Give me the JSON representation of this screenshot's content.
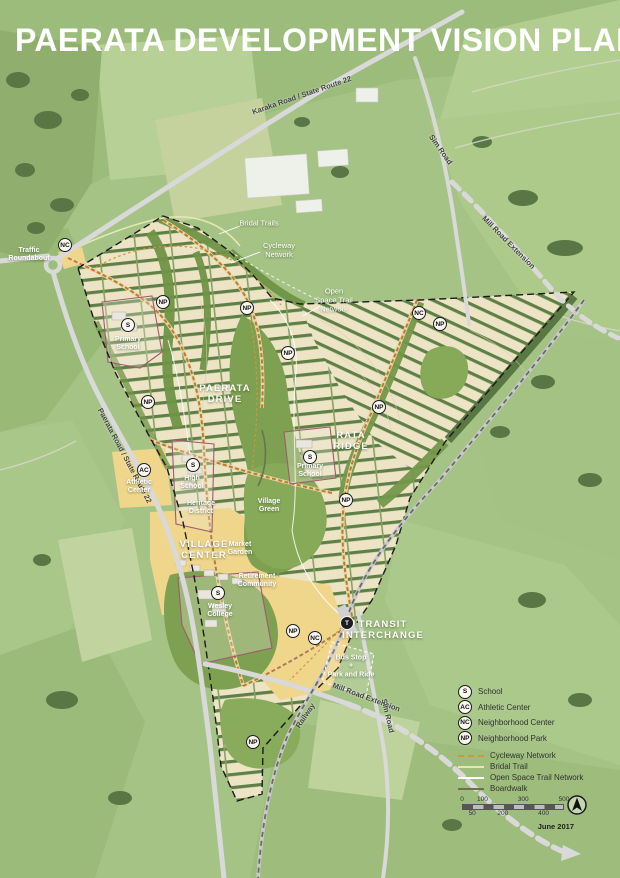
{
  "title": "PAERATA DEVELOPMENT VISION PLAN",
  "date": "June 2017",
  "colors": {
    "plan_cream": "#ece4c5",
    "street_green": "#5e8047",
    "village_green": "#7da150",
    "yellow_zone": "#f0d68b",
    "main_street_orange": "#bf7a30",
    "cycleway_orange": "#d0983c",
    "bridal_trail": "#e4e8b6",
    "open_space_trail": "#ffffff",
    "boardwalk": "#6f6f52",
    "road_gray": "#d9d9d9",
    "boundary_black": "#1b1b1b"
  },
  "road_labels": [
    {
      "text": "Karaka Road / State Route 22",
      "x": 302,
      "y": 96,
      "rotate": -19
    },
    {
      "text": "Sim Road",
      "x": 440,
      "y": 150,
      "rotate": 55
    },
    {
      "text": "Mill Road Extension",
      "x": 508,
      "y": 243,
      "rotate": 45
    },
    {
      "text": "Paerata Road / State Route 22",
      "x": 124,
      "y": 456,
      "rotate": 62
    },
    {
      "text": "Mill Road Extension",
      "x": 366,
      "y": 698,
      "rotate": 20
    },
    {
      "text": "Sim Road",
      "x": 387,
      "y": 716,
      "rotate": 77
    },
    {
      "text": "Railway",
      "x": 306,
      "y": 716,
      "rotate": -56
    }
  ],
  "area_labels": [
    {
      "text": "PAERATA\nDRIVE",
      "x": 225,
      "y": 394,
      "style": "district"
    },
    {
      "text": "RATA\nRIDGE",
      "x": 351,
      "y": 441,
      "style": "district"
    },
    {
      "text": "VILLAGE\nCENTER",
      "x": 204,
      "y": 550,
      "style": "district"
    },
    {
      "text": "TRANSIT\nINTERCHANGE",
      "x": 383,
      "y": 630,
      "style": "district"
    },
    {
      "text": "Primary\nSchool",
      "x": 128,
      "y": 344,
      "style": "feature"
    },
    {
      "text": "Primary\nSchool",
      "x": 310,
      "y": 471,
      "style": "feature"
    },
    {
      "text": "High\nSchool",
      "x": 192,
      "y": 483,
      "style": "feature"
    },
    {
      "text": "Athletic\nCenter",
      "x": 139,
      "y": 487,
      "style": "feature"
    },
    {
      "text": "Heritage\nDistrict",
      "x": 201,
      "y": 508,
      "style": "feature"
    },
    {
      "text": "Village\nGreen",
      "x": 269,
      "y": 506,
      "style": "feature"
    },
    {
      "text": "Market\nGarden",
      "x": 240,
      "y": 549,
      "style": "feature"
    },
    {
      "text": "Wesley\nCollege",
      "x": 220,
      "y": 611,
      "style": "feature"
    },
    {
      "text": "Retirement\nCommunity",
      "x": 257,
      "y": 581,
      "style": "feature"
    },
    {
      "text": "Bus Stop\n+\nPark and Ride",
      "x": 351,
      "y": 667,
      "style": "feature"
    },
    {
      "text": "Traffic\nRoundabout",
      "x": 29,
      "y": 255,
      "style": "feature"
    }
  ],
  "callout_labels": [
    {
      "text": "Bridal Trails",
      "x": 259,
      "y": 224
    },
    {
      "text": "Cycleway\nNetwork",
      "x": 279,
      "y": 251
    },
    {
      "text": "Open\nSpace Trail\nNetwork",
      "x": 334,
      "y": 301
    }
  ],
  "badges": [
    {
      "type": "NC",
      "x": 65,
      "y": 245
    },
    {
      "type": "S",
      "x": 128,
      "y": 325
    },
    {
      "type": "NP",
      "x": 163,
      "y": 302
    },
    {
      "type": "NP",
      "x": 247,
      "y": 308
    },
    {
      "type": "NP",
      "x": 288,
      "y": 353
    },
    {
      "type": "NC",
      "x": 419,
      "y": 313
    },
    {
      "type": "NP",
      "x": 440,
      "y": 324
    },
    {
      "type": "NP",
      "x": 148,
      "y": 402
    },
    {
      "type": "NP",
      "x": 379,
      "y": 407
    },
    {
      "type": "S",
      "x": 193,
      "y": 465
    },
    {
      "type": "AC",
      "x": 144,
      "y": 470
    },
    {
      "type": "S",
      "x": 310,
      "y": 457
    },
    {
      "type": "NP",
      "x": 346,
      "y": 500
    },
    {
      "type": "S",
      "x": 218,
      "y": 593
    },
    {
      "type": "NP",
      "x": 293,
      "y": 631
    },
    {
      "type": "NC",
      "x": 315,
      "y": 638
    },
    {
      "type": "T",
      "x": 347,
      "y": 623
    },
    {
      "type": "NP",
      "x": 253,
      "y": 742
    }
  ],
  "legend": {
    "items": [
      {
        "badge": "S",
        "label": "School"
      },
      {
        "badge": "AC",
        "label": "Athletic Center"
      },
      {
        "badge": "NC",
        "label": "Neighborhood Center"
      },
      {
        "badge": "NP",
        "label": "Neighborhood Park"
      }
    ],
    "lines": [
      {
        "key": "cycleway",
        "label": "Cycleway Network"
      },
      {
        "key": "bridal",
        "label": "Bridal Trail"
      },
      {
        "key": "openspace",
        "label": "Open Space Trail Network"
      },
      {
        "key": "boardwalk",
        "label": "Boardwalk"
      }
    ],
    "scale": {
      "top_ticks": [
        "0",
        "100",
        "300",
        "500"
      ],
      "bottom_ticks": [
        "50",
        "200",
        "400"
      ],
      "max": 500
    }
  }
}
